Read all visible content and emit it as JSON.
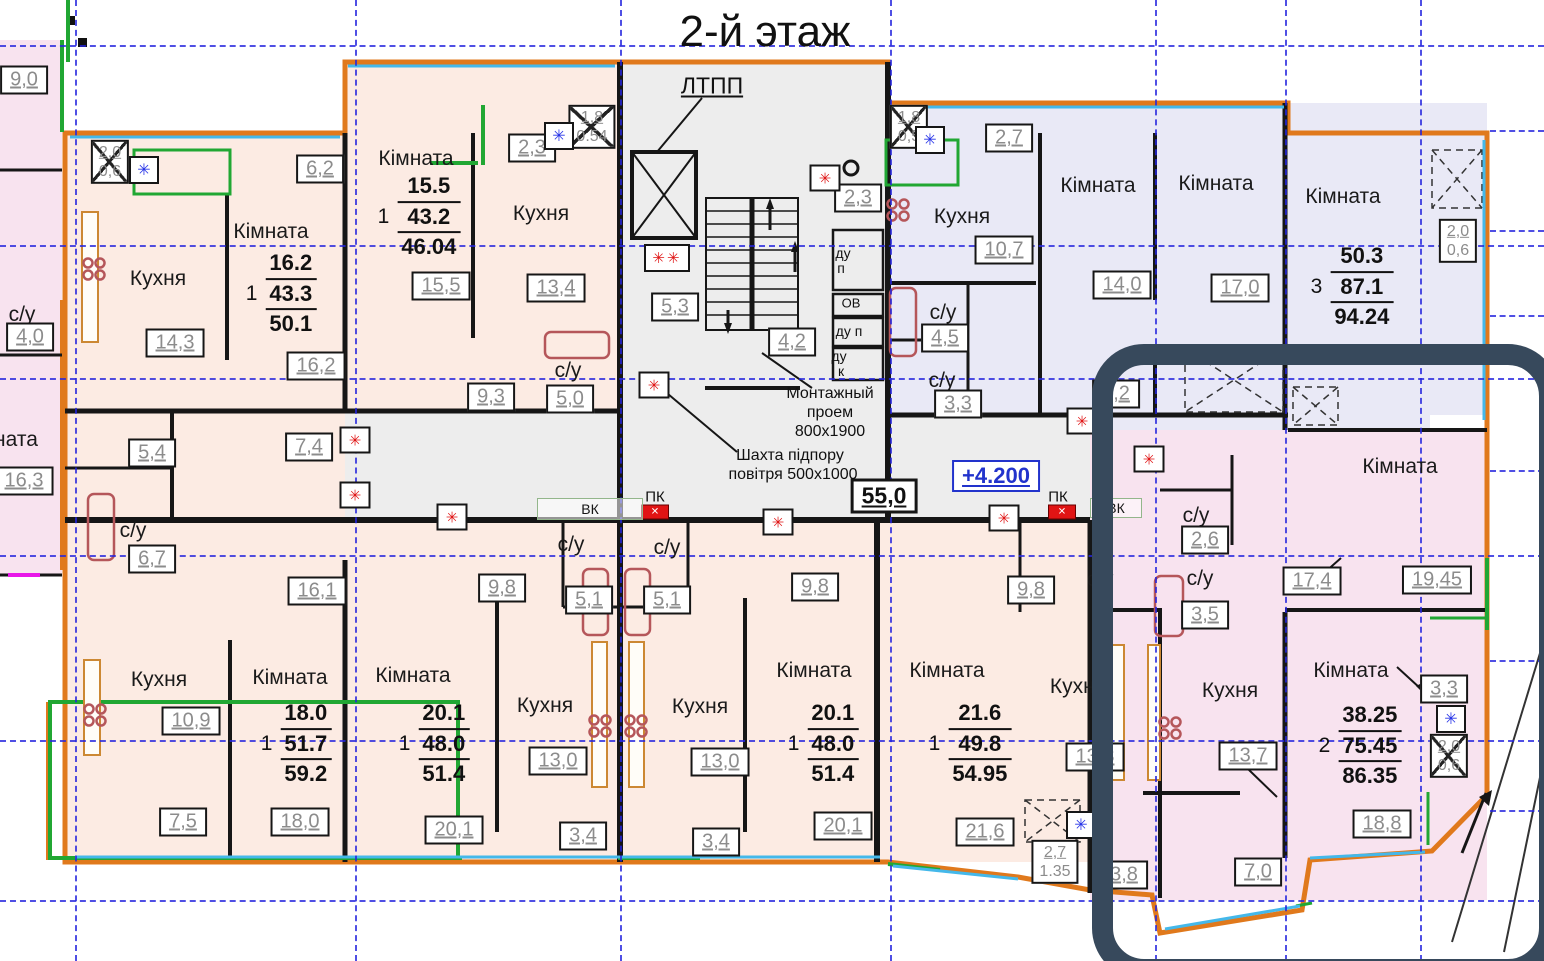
{
  "title": "2-й этаж",
  "colors": {
    "outline_orange": "#e0791c",
    "wall_black": "#161616",
    "grid_blue": "#2424de",
    "peach_fill": "#fcebe3",
    "lavender_fill": "#e9e9f6",
    "pink_fill": "#f8e3ef",
    "gray_fill": "#ededed",
    "balcony_green": "#21a733",
    "window_cyan": "#44b8ea",
    "fixture_maroon": "#b5565a",
    "marker_red": "#e01414",
    "marker_blue": "#2633e8",
    "level_blue": "#2233cc",
    "highlight_navy": "#37495c"
  },
  "regions": [
    {
      "name": "neighbor-building",
      "x": 0,
      "y": 40,
      "w": 62,
      "h": 536,
      "fill": "#f8e3ef"
    },
    {
      "name": "apt2-top-projection",
      "x": 345,
      "y": 62,
      "w": 275,
      "h": 75,
      "fill": "#fcebe3"
    },
    {
      "name": "left-apartments",
      "x": 65,
      "y": 133,
      "w": 555,
      "h": 279,
      "fill": "#fcebe3"
    },
    {
      "name": "stair-core",
      "x": 620,
      "y": 62,
      "w": 268,
      "h": 458,
      "fill": "#ededed"
    },
    {
      "name": "corridor",
      "x": 345,
      "y": 412,
      "w": 745,
      "h": 108,
      "fill": "#ededed"
    },
    {
      "name": "left-mid-bathrooms",
      "x": 65,
      "y": 412,
      "w": 280,
      "h": 108,
      "fill": "#fcebe3"
    },
    {
      "name": "blue-section",
      "x": 888,
      "y": 103,
      "w": 599,
      "h": 312,
      "fill": "#e9e9f6"
    },
    {
      "name": "blue-section-lower",
      "x": 1090,
      "y": 345,
      "w": 340,
      "h": 85,
      "fill": "#e9e9f6"
    },
    {
      "name": "bottom-apartments",
      "x": 65,
      "y": 520,
      "w": 1025,
      "h": 342,
      "fill": "#fcebe3"
    },
    {
      "name": "right-pink-upper",
      "x": 1090,
      "y": 430,
      "w": 397,
      "h": 180,
      "fill": "#f8e3ef"
    },
    {
      "name": "right-pink-lower",
      "x": 1090,
      "y": 610,
      "w": 397,
      "h": 290,
      "fill": "#f8e3ef"
    }
  ],
  "grid": {
    "verticals": [
      75,
      355,
      620,
      890,
      1155,
      1285,
      1420
    ],
    "horizontals": [
      45,
      245,
      378,
      555,
      740,
      900
    ],
    "right_stubs": [
      130,
      230,
      315,
      470,
      660,
      810
    ]
  },
  "room_labels": [
    {
      "t": "Кухня",
      "x": 158,
      "y": 279
    },
    {
      "t": "Кімната",
      "x": 271,
      "y": 232
    },
    {
      "t": "Кімната",
      "x": 416,
      "y": 159
    },
    {
      "t": "Кухня",
      "x": 541,
      "y": 214
    },
    {
      "t": "с/у",
      "x": 568,
      "y": 371
    },
    {
      "t": "Кухня",
      "x": 962,
      "y": 217
    },
    {
      "t": "Кімната",
      "x": 1098,
      "y": 186
    },
    {
      "t": "Кімната",
      "x": 1216,
      "y": 184
    },
    {
      "t": "Кімната",
      "x": 1343,
      "y": 197
    },
    {
      "t": "с/у",
      "x": 943,
      "y": 313
    },
    {
      "t": "с/у",
      "x": 942,
      "y": 381
    },
    {
      "t": "с/у",
      "x": 133,
      "y": 531
    },
    {
      "t": "с/у",
      "x": 22,
      "y": 315
    },
    {
      "t": "ната",
      "x": 16,
      "y": 440
    },
    {
      "t": "с/у",
      "x": 571,
      "y": 545
    },
    {
      "t": "с/у",
      "x": 667,
      "y": 548
    },
    {
      "t": "Кімната",
      "x": 1400,
      "y": 467
    },
    {
      "t": "с/у",
      "x": 1196,
      "y": 516
    },
    {
      "t": "с/у",
      "x": 1200,
      "y": 579
    },
    {
      "t": "с/у",
      "x": 1100,
      "y": 580
    },
    {
      "t": "Кухня",
      "x": 159,
      "y": 680
    },
    {
      "t": "Кімната",
      "x": 290,
      "y": 678
    },
    {
      "t": "Кімната",
      "x": 413,
      "y": 676
    },
    {
      "t": "Кухня",
      "x": 545,
      "y": 706
    },
    {
      "t": "Кухня",
      "x": 700,
      "y": 707
    },
    {
      "t": "Кімната",
      "x": 814,
      "y": 671
    },
    {
      "t": "Кімната",
      "x": 947,
      "y": 671
    },
    {
      "t": "Кухня",
      "x": 1078,
      "y": 687
    },
    {
      "t": "Кухня",
      "x": 1230,
      "y": 691
    },
    {
      "t": "Кімната",
      "x": 1351,
      "y": 671
    }
  ],
  "area_boxes": [
    {
      "t": "6,2",
      "x": 320,
      "y": 169
    },
    {
      "t": "16,2",
      "x": 316,
      "y": 366
    },
    {
      "t": "14,3",
      "x": 175,
      "y": 343
    },
    {
      "t": "15,5",
      "x": 441,
      "y": 286
    },
    {
      "t": "13,4",
      "x": 556,
      "y": 288
    },
    {
      "t": "2,3",
      "x": 532,
      "y": 148
    },
    {
      "t": "9,3",
      "x": 491,
      "y": 397
    },
    {
      "t": "5,0",
      "x": 570,
      "y": 399
    },
    {
      "t": "5,3",
      "x": 675,
      "y": 307
    },
    {
      "t": "2,3",
      "x": 858,
      "y": 198
    },
    {
      "t": "4,2",
      "x": 792,
      "y": 342
    },
    {
      "t": "55,0",
      "x": 884,
      "y": 496,
      "big": true
    },
    {
      "t": "+4.200",
      "x": 996,
      "y": 476,
      "blue": true
    },
    {
      "t": "10,7",
      "x": 1004,
      "y": 250
    },
    {
      "t": "14,0",
      "x": 1122,
      "y": 285
    },
    {
      "t": "17,0",
      "x": 1240,
      "y": 288
    },
    {
      "t": "4,5",
      "x": 945,
      "y": 338
    },
    {
      "t": "3,3",
      "x": 958,
      "y": 404
    },
    {
      "t": "2,7",
      "x": 1009,
      "y": 138
    },
    {
      "t": "8,2",
      "x": 1116,
      "y": 394
    },
    {
      "t": "17,4",
      "x": 1312,
      "y": 581
    },
    {
      "t": "19,45",
      "x": 1437,
      "y": 580
    },
    {
      "t": "2,6",
      "x": 1205,
      "y": 540
    },
    {
      "t": "3,5",
      "x": 1205,
      "y": 615
    },
    {
      "t": "5,4",
      "x": 152,
      "y": 453
    },
    {
      "t": "7,4",
      "x": 309,
      "y": 447
    },
    {
      "t": "6,7",
      "x": 152,
      "y": 559
    },
    {
      "t": "16,1",
      "x": 317,
      "y": 591
    },
    {
      "t": "10,9",
      "x": 191,
      "y": 721
    },
    {
      "t": "7,5",
      "x": 183,
      "y": 822
    },
    {
      "t": "18,0",
      "x": 300,
      "y": 822
    },
    {
      "t": "9,8",
      "x": 502,
      "y": 588
    },
    {
      "t": "5,1",
      "x": 589,
      "y": 600
    },
    {
      "t": "5,1",
      "x": 667,
      "y": 600
    },
    {
      "t": "13,0",
      "x": 558,
      "y": 761
    },
    {
      "t": "3,4",
      "x": 583,
      "y": 836
    },
    {
      "t": "20,1",
      "x": 454,
      "y": 830
    },
    {
      "t": "9,8",
      "x": 815,
      "y": 587
    },
    {
      "t": "13,0",
      "x": 720,
      "y": 762
    },
    {
      "t": "3,4",
      "x": 716,
      "y": 842
    },
    {
      "t": "20,1",
      "x": 843,
      "y": 826
    },
    {
      "t": "21,6",
      "x": 985,
      "y": 832
    },
    {
      "t": "9,8",
      "x": 1031,
      "y": 590
    },
    {
      "t": "13,3",
      "x": 1095,
      "y": 757
    },
    {
      "t": "13,7",
      "x": 1248,
      "y": 756
    },
    {
      "t": "3,8",
      "x": 1124,
      "y": 875
    },
    {
      "t": "7,0",
      "x": 1258,
      "y": 872
    },
    {
      "t": "18,8",
      "x": 1382,
      "y": 824
    },
    {
      "t": "3,3",
      "x": 1444,
      "y": 689
    },
    {
      "t": "9,0",
      "x": 24,
      "y": 80
    },
    {
      "t": "4,0",
      "x": 30,
      "y": 337
    },
    {
      "t": "16,3",
      "x": 24,
      "y": 481
    }
  ],
  "stacked_boxes": [
    {
      "top": "2,0",
      "bottom": "0,6",
      "x": 110,
      "y": 162,
      "crossed": true
    },
    {
      "top": "1,8",
      "bottom": "0.54",
      "x": 592,
      "y": 127,
      "crossed": true
    },
    {
      "top": "1,8",
      "bottom": "0,5",
      "x": 909,
      "y": 127,
      "crossed": true
    },
    {
      "top": "2,0",
      "bottom": "0,6",
      "x": 1458,
      "y": 241,
      "crossed": false
    },
    {
      "top": "2,0",
      "bottom": "0,6",
      "x": 1449,
      "y": 756,
      "crossed": true
    },
    {
      "top": "2,7",
      "bottom": "1.35",
      "x": 1055,
      "y": 862,
      "crossed": false
    }
  ],
  "apartments": [
    {
      "rooms": "1",
      "values": [
        "16.2",
        "43.3",
        "50.1"
      ],
      "x": 281,
      "y": 294
    },
    {
      "rooms": "1",
      "values": [
        "15.5",
        "43.2",
        "46.04"
      ],
      "x": 419,
      "y": 217
    },
    {
      "rooms": "3",
      "values": [
        "50.3",
        "87.1",
        "94.24"
      ],
      "x": 1352,
      "y": 287
    },
    {
      "rooms": "1",
      "values": [
        "18.0",
        "51.7",
        "59.2"
      ],
      "x": 296,
      "y": 744
    },
    {
      "rooms": "1",
      "values": [
        "20.1",
        "48.0",
        "51.4"
      ],
      "x": 434,
      "y": 744
    },
    {
      "rooms": "1",
      "values": [
        "20.1",
        "48.0",
        "51.4"
      ],
      "x": 823,
      "y": 744
    },
    {
      "rooms": "1",
      "values": [
        "21.6",
        "49.8",
        "54.95"
      ],
      "x": 970,
      "y": 744
    },
    {
      "rooms": "2",
      "values": [
        "38.25",
        "75.45",
        "86.35"
      ],
      "x": 1360,
      "y": 746
    }
  ],
  "annotations": [
    {
      "text": "2-й этаж",
      "x": 765,
      "y": 32,
      "size": 44
    },
    {
      "text": "ЛТПП",
      "x": 712,
      "y": 86,
      "size": 23,
      "underline": true
    },
    {
      "text": "Монтажный",
      "x": 830,
      "y": 394,
      "size": 16
    },
    {
      "text": "проем",
      "x": 830,
      "y": 413,
      "size": 16
    },
    {
      "text": "800х1900",
      "x": 830,
      "y": 432,
      "size": 16
    },
    {
      "text": "Шахта підпору",
      "x": 790,
      "y": 456,
      "size": 16
    },
    {
      "text": "повітря 500х1000",
      "x": 793,
      "y": 475,
      "size": 16
    },
    {
      "text": "ду",
      "x": 843,
      "y": 253,
      "size": 14
    },
    {
      "text": "п",
      "x": 841,
      "y": 268,
      "size": 14
    },
    {
      "text": "ОВ",
      "x": 851,
      "y": 303,
      "size": 13
    },
    {
      "text": "ду п",
      "x": 849,
      "y": 331,
      "size": 14
    },
    {
      "text": "ду",
      "x": 839,
      "y": 356,
      "size": 14
    },
    {
      "text": "к",
      "x": 841,
      "y": 371,
      "size": 14
    },
    {
      "text": "ПК",
      "x": 655,
      "y": 497,
      "size": 15
    },
    {
      "text": "ПК",
      "x": 1058,
      "y": 497,
      "size": 15
    },
    {
      "text": "3",
      "x": 1537,
      "y": 950,
      "size": 14
    }
  ],
  "markers": {
    "red": [
      [
        825,
        178
      ],
      [
        654,
        385
      ],
      [
        355,
        440
      ],
      [
        355,
        495
      ],
      [
        452,
        517
      ],
      [
        778,
        522
      ],
      [
        1004,
        518
      ],
      [
        1082,
        421
      ],
      [
        1149,
        459
      ]
    ],
    "red_double": [
      [
        667,
        258
      ]
    ],
    "blue": [
      [
        144,
        170
      ],
      [
        559,
        136
      ],
      [
        930,
        140
      ],
      [
        1081,
        825
      ],
      [
        1451,
        719
      ]
    ]
  },
  "pk_symbols": [
    [
      655,
      512
    ],
    [
      1062,
      512
    ]
  ],
  "vk_boxes": [
    {
      "t": "ВК",
      "x": 590,
      "y": 509,
      "w": 104,
      "h": 20
    },
    {
      "t": "ВК",
      "x": 1116,
      "y": 508,
      "w": 50,
      "h": 18
    }
  ],
  "highlight_box": {
    "x": 1092,
    "y": 344,
    "w": 426,
    "h": 594
  }
}
